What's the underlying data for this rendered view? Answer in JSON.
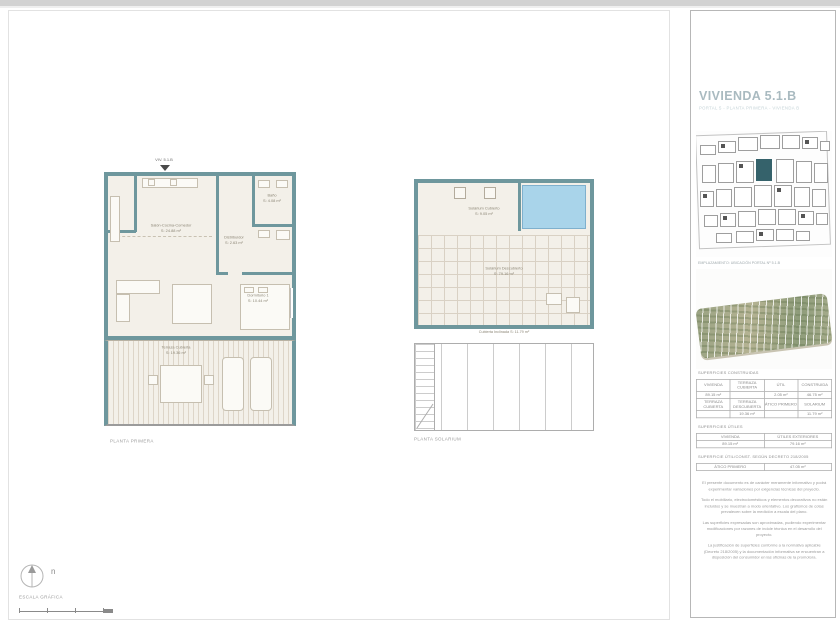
{
  "sheet": {
    "plan1": {
      "unit_label": "VIV. 5.1.B",
      "caption": "PLANTA PRIMERA",
      "rooms": {
        "living": {
          "name": "Salón-Cocina-Comedor",
          "area": "S: 24.88 m²"
        },
        "bath": {
          "name": "Baño",
          "area": "S: 4.08 m²"
        },
        "hall": {
          "name": "Distribuidor",
          "area": "S: 2.63 m²"
        },
        "bedroom": {
          "name": "Dormitorio 1",
          "area": "S: 10.44 m²"
        },
        "terrace": {
          "name": "Terraza Cubierta",
          "area": "S: 19.36 m²"
        }
      }
    },
    "plan2": {
      "caption": "PLANTA SOLARIUM",
      "rooms": {
        "covered": {
          "name": "Solárium Cubierto",
          "area": "S: 9.05 m²"
        },
        "open": {
          "name": "Solárium Descubierto",
          "area": "S: 79.16 m²"
        },
        "roof": {
          "name": "Cubierta Inclinada",
          "area": "S: 11.79 m²"
        }
      }
    },
    "north_label": "n",
    "scale_label": "ESCALA GRÁFICA"
  },
  "panel": {
    "title": "VIVIENDA 5.1.B",
    "subtitle": "PORTAL 5 - PLANTA PRIMERA - VIVIENDA B",
    "siteplan_caption": "EMPLAZAMIENTO: UBICACIÓN PORTAL Nº 5.1.B",
    "sections": {
      "built_label": "SUPERFICIES CONSTRUIDAS",
      "useful_label": "SUPERFICIES ÚTILES",
      "regulation_label": "SUPERFICIE ÚTIL/CONST. SEGÚN DECRETO 218/2005"
    },
    "tables": {
      "built": {
        "rows": [
          [
            "VIVIENDA",
            "TERRAZA CUBIERTA",
            "ÚTIL",
            "CONSTRUIDA"
          ],
          [
            "89.15 m²",
            "",
            "2.05 m²",
            "46.75 m²"
          ],
          [
            "TERRAZA CUBIERTA",
            "TERRAZA DESCUBIERTA",
            "ÁTICO PRIMERO",
            "SOLARIUM"
          ],
          [
            "",
            "19.36 m²",
            "",
            "11.79 m²"
          ]
        ]
      },
      "useful": {
        "rows": [
          [
            "VIVIENDA",
            "ÚTILES EXTERIORES"
          ],
          [
            "89.15 m²",
            "79.16 m²"
          ]
        ]
      },
      "regulation": {
        "rows": [
          [
            "ÁTICO PRIMERO",
            "47.05 m²"
          ]
        ]
      }
    },
    "disclaimers": [
      "El presente documento es de carácter meramente informativo y podrá experimentar variaciones por exigencias técnicas del proyecto.",
      "Todo el mobiliario, electrodomésticos y elementos decorativos no están incluidos y se muestran a modo orientativo. Los grafismos de cotas prevalecen sobre la medición a escala del plano.",
      "Las superficies expresadas son aproximadas, pudiendo experimentar modificaciones por razones de índole técnica en el desarrollo del proyecto.",
      "La justificación de superficies conforme a la normativa aplicable (Decreto 218/2005) y la documentación informativa se encuentran a disposición del consumidor en las oficinas de la promotora."
    ],
    "colors": {
      "wall_teal": "#6e979d",
      "pool_blue": "#a9d4ea",
      "highlight_unit": "#35626b"
    }
  }
}
